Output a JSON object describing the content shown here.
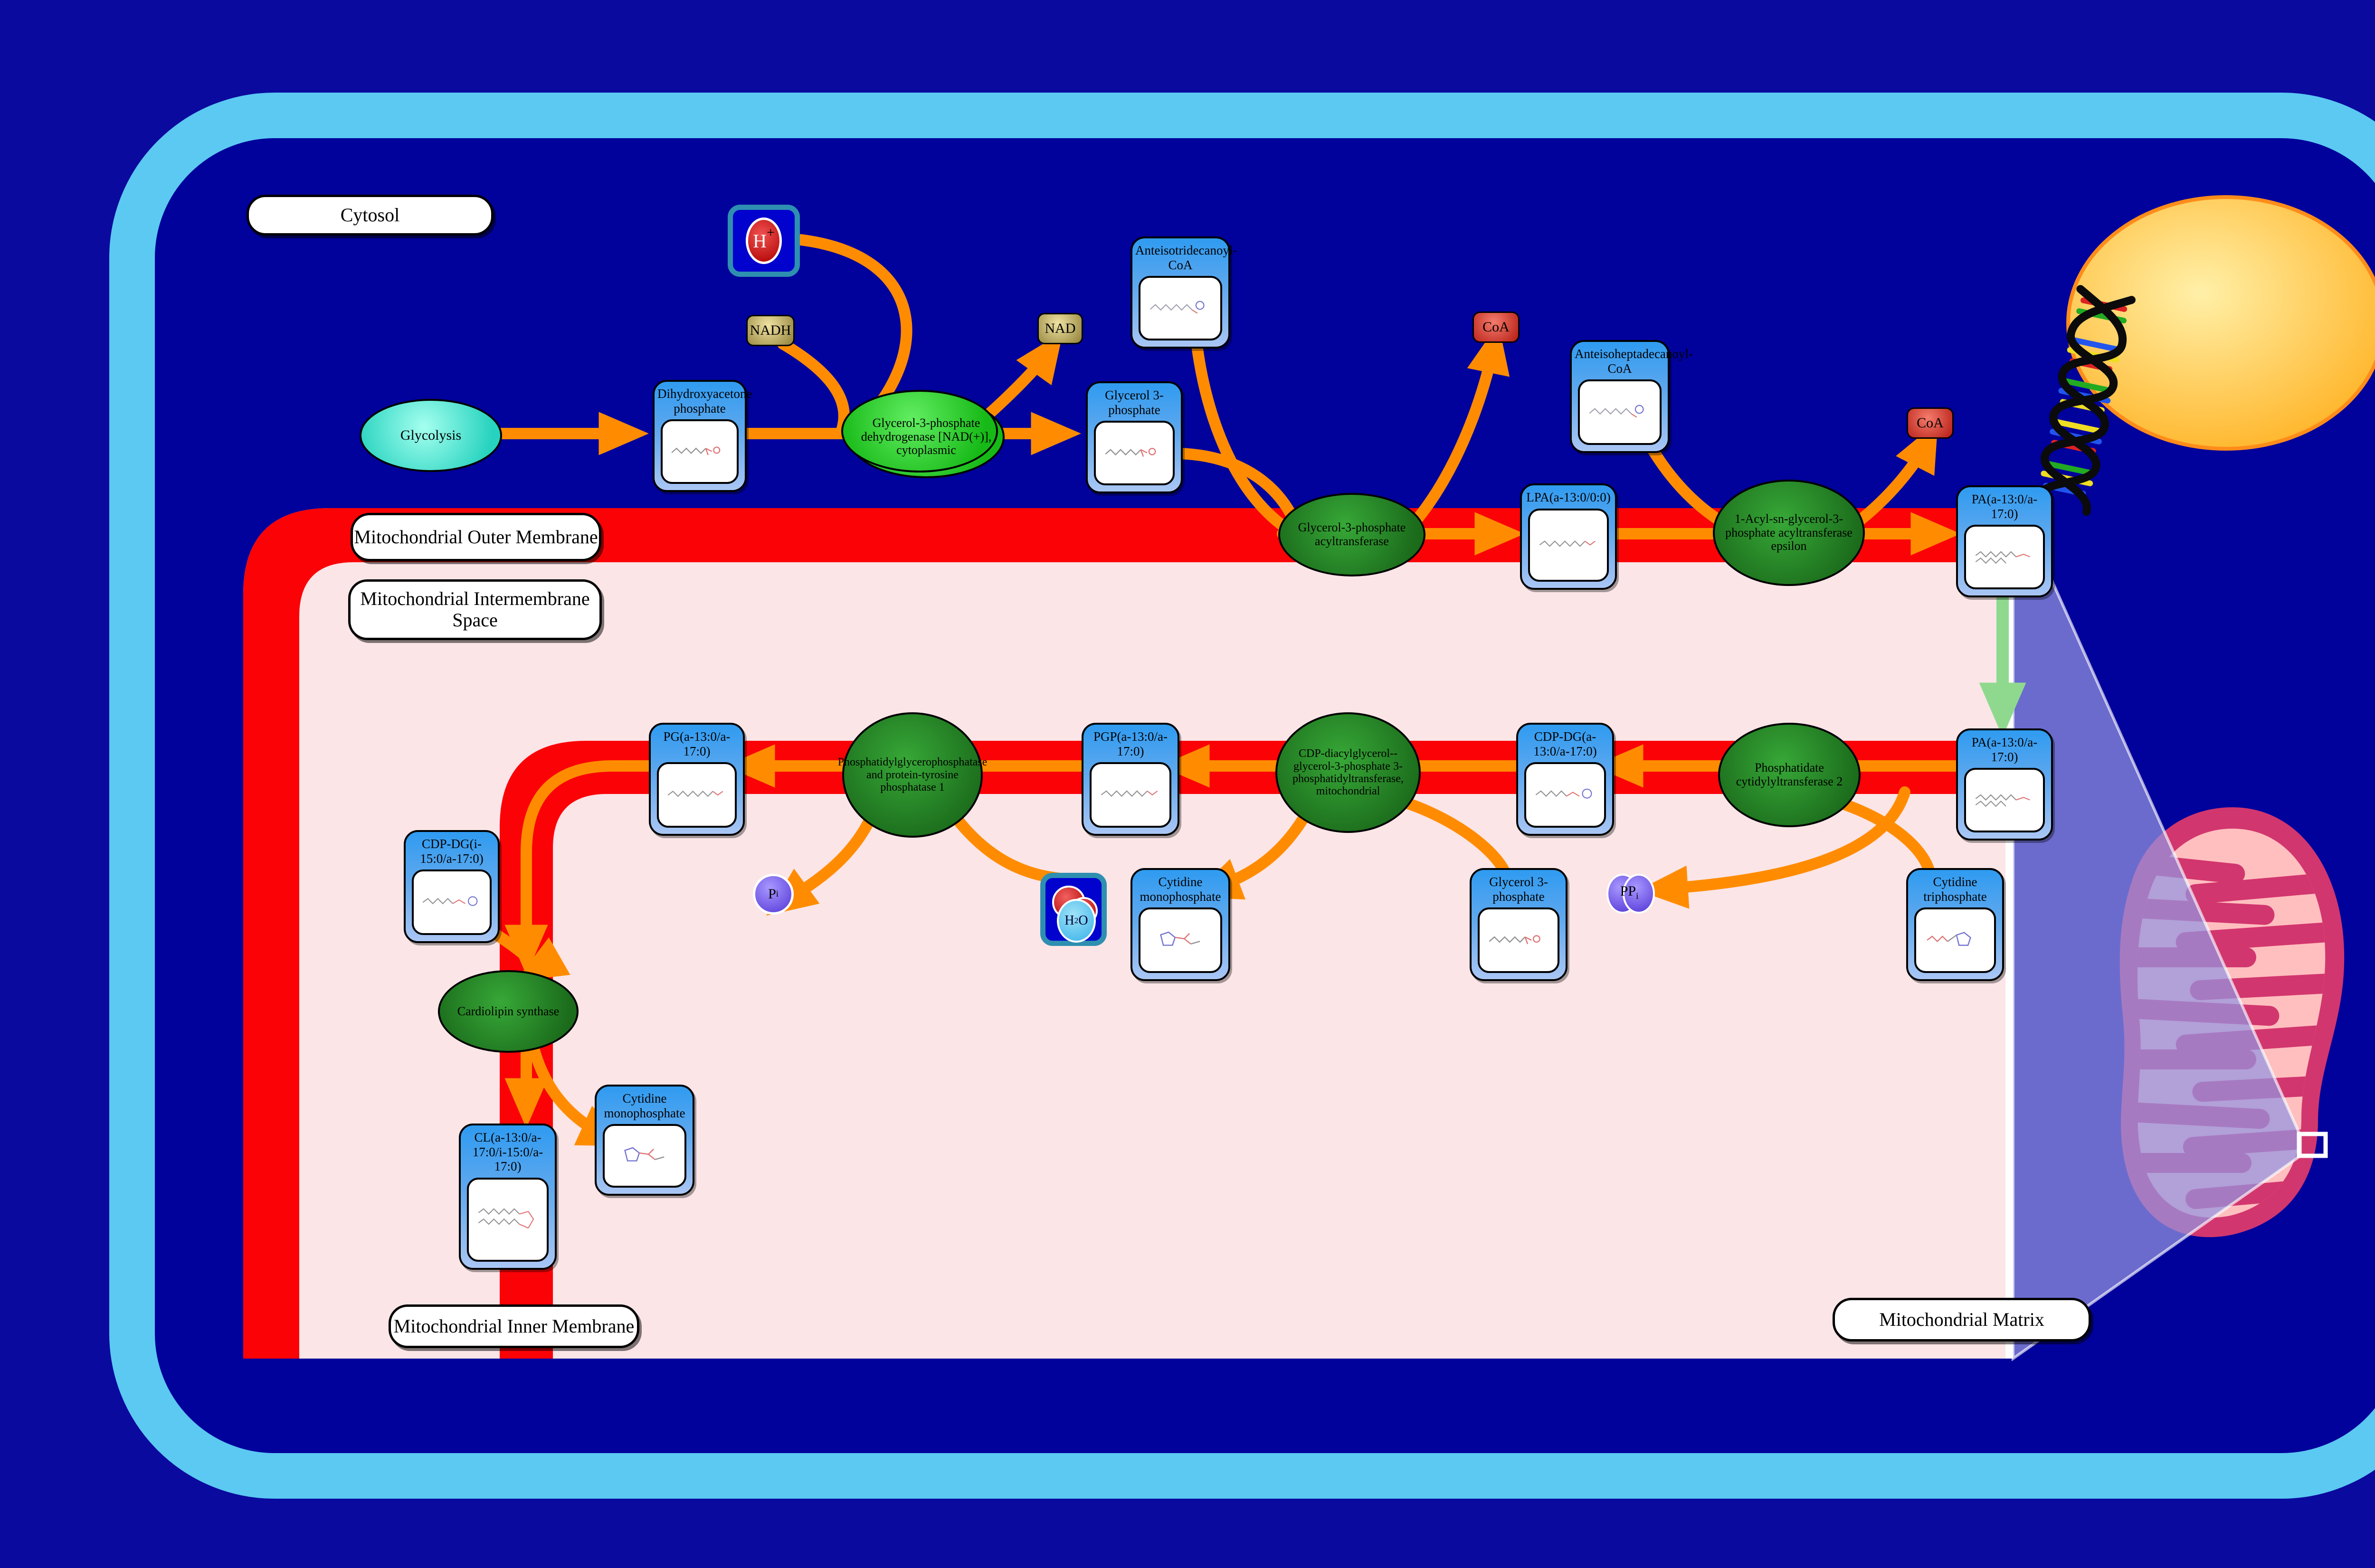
{
  "regions": {
    "cytosol": "Cytosol",
    "outer_membrane": "Mitochondrial Outer Membrane",
    "intermembrane_space": "Mitochondrial Intermembrane Space",
    "inner_membrane": "Mitochondrial Inner Membrane",
    "matrix": "Mitochondrial Matrix"
  },
  "process": {
    "glycolysis": "Glycolysis"
  },
  "metabolites": {
    "dhap": "Dihydroxyacetone phosphate",
    "g3p_cytosol": "Glycerol 3-phosphate",
    "anteisotridecanoyl_coa": "Anteisotridecanoyl-CoA",
    "lpa": "LPA(a-13:0/0:0)",
    "anteisoheptadecanoyl_coa": "Anteisoheptadecanoyl-CoA",
    "pa_upper": "PA(a-13:0/a-17:0)",
    "pa_lower": "PA(a-13:0/a-17:0)",
    "cdp_dg_a": "CDP-DG(a-13:0/a-17:0)",
    "pgp": "PGP(a-13:0/a-17:0)",
    "pg": "PG(a-13:0/a-17:0)",
    "cmp_mid": "Cytidine monophosphate",
    "g3p_matrix": "Glycerol 3-phosphate",
    "ctp": "Cytidine triphosphate",
    "cdp_dg_i": "CDP-DG(i-15:0/a-17:0)",
    "cmp_low": "Cytidine monophosphate",
    "cl": "CL(a-13:0/a-17:0/i-15:0/a-17:0)"
  },
  "enzymes": {
    "gpd1": "Glycerol-3-phosphate dehydrogenase [NAD(+)], cytoplasmic",
    "gpat": "Glycerol-3-phosphate acyltransferase",
    "agpat_epsilon": "1-Acyl-sn-glycerol-3-phosphate acyltransferase epsilon",
    "cds2": "Phosphatidate cytidylyltransferase 2",
    "pgs1": "CDP-diacylglycerol--glycerol-3-phosphate 3-phosphatidyltransferase, mitochondrial",
    "ptpmt1": "Phosphatidylglycerophosphatase and protein-tyrosine phosphatase 1",
    "crls1": "Cardiolipin synthase"
  },
  "cofactors": {
    "h_plus": "H",
    "h_plus_sup": "+",
    "nadh": "NADH",
    "nad": "NAD",
    "coa_1": "CoA",
    "coa_2": "CoA",
    "h2o_h": "H",
    "h2o_sub": "2",
    "h2o_o": "O",
    "pi_p": "P",
    "pi_sub": "i",
    "ppi_p": "PP",
    "ppi_sub": "i"
  },
  "colors": {
    "page_background": "#0A0A9E",
    "cell_border": "#5BC9F2",
    "membrane_red": "#FB0207",
    "intermembrane_pink": "#FBE5E7",
    "node_blue": "#2F9BF0",
    "enzyme_green_dark": "#1E7D1E",
    "enzyme_green_bright": "#2FD32F",
    "arrow_orange": "#FF8C00",
    "transport_arrow_green": "#8FD98F",
    "nucleus_yellow": "#FFC32B",
    "mitochondrion_crimson": "#D2366E"
  }
}
